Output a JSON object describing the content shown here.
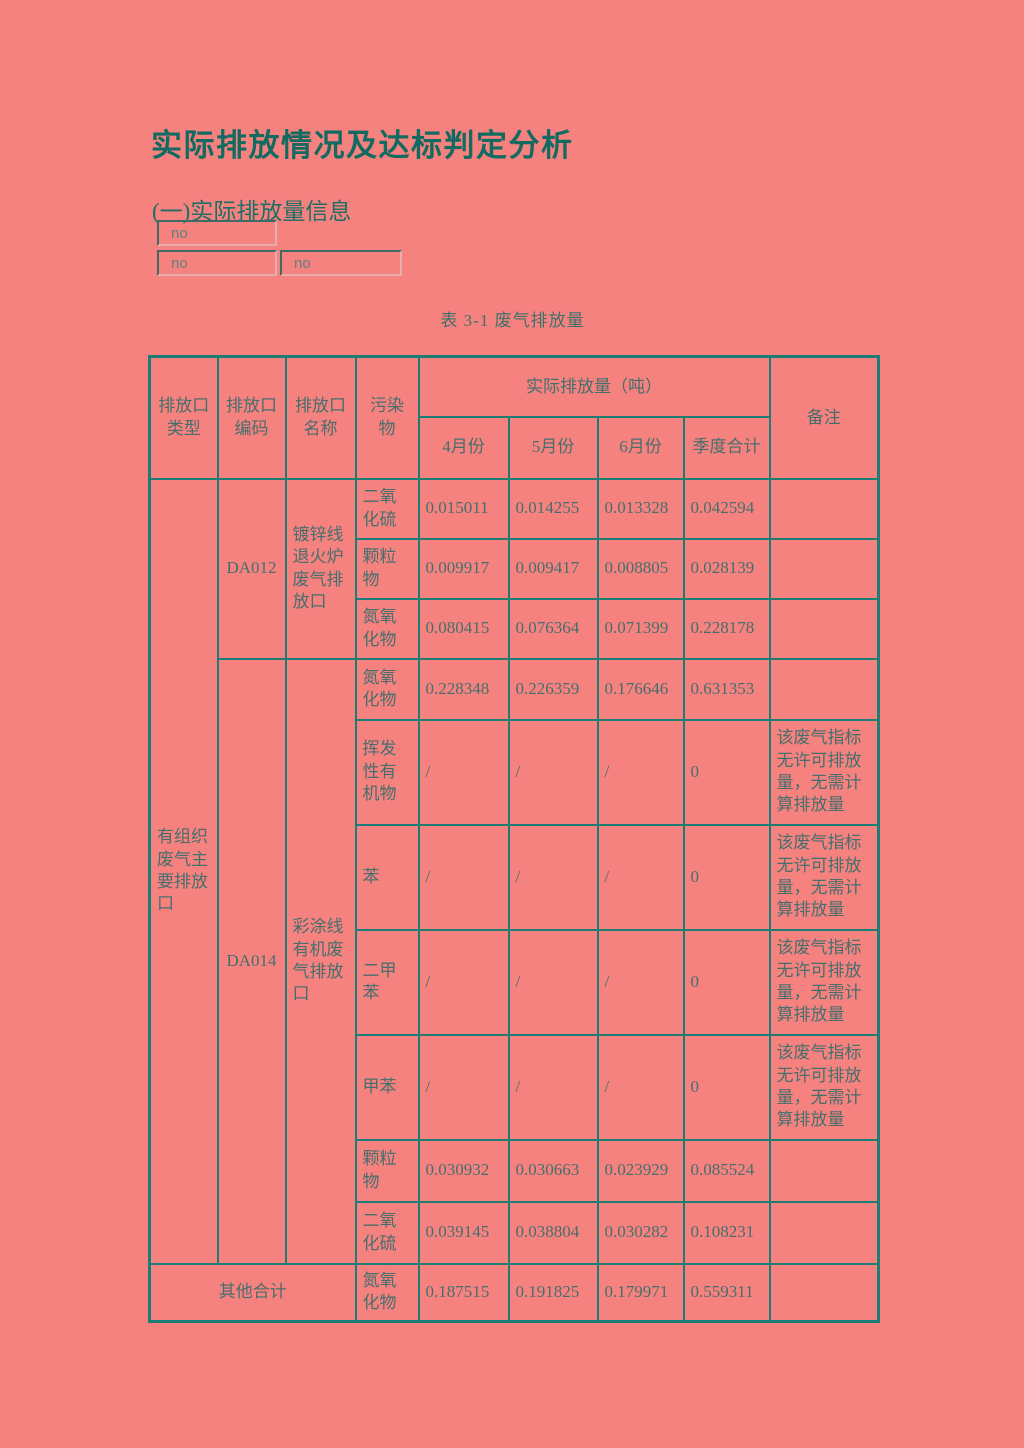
{
  "page": {
    "title": "实际排放情况及达标判定分析",
    "section_heading": "(一)实际排放量信息",
    "table_caption": "表 3-1 废气排放量"
  },
  "fields": [
    {
      "value": "no"
    },
    {
      "value": "no"
    },
    {
      "value": "no"
    }
  ],
  "colors": {
    "page_background": "#f6827f",
    "table_border": "#1b7d75",
    "title_text": "#136a60",
    "table_text": "#456f6d",
    "field_text": "#5d827f"
  },
  "table": {
    "header": {
      "outlet_type": "排放口类型",
      "outlet_code": "排放口编码",
      "outlet_name": "排放口名称",
      "pollutant": "污染物",
      "actual_emissions": "实际排放量（吨）",
      "april": "4月份",
      "may": "5月份",
      "june": "6月份",
      "quarter_total": "季度合计",
      "remark": "备注"
    },
    "group_label": "有组织废气主要排放口",
    "outlets": [
      {
        "code": "DA012",
        "name": "镀锌线退火炉废气排放口"
      },
      {
        "code": "DA014",
        "name": "彩涂线有机废气排放口"
      }
    ],
    "no_permit_remark": "该废气指标无许可排放量，无需计算排放量",
    "rows": [
      {
        "pollutant": "二氧化硫",
        "april": "0.015011",
        "may": "0.014255",
        "june": "0.013328",
        "quarter_total": "0.042594",
        "remark": ""
      },
      {
        "pollutant": "颗粒物",
        "april": "0.009917",
        "may": "0.009417",
        "june": "0.008805",
        "quarter_total": "0.028139",
        "remark": ""
      },
      {
        "pollutant": "氮氧化物",
        "april": "0.080415",
        "may": "0.076364",
        "june": "0.071399",
        "quarter_total": "0.228178",
        "remark": ""
      },
      {
        "pollutant": "氮氧化物",
        "april": "0.228348",
        "may": "0.226359",
        "june": "0.176646",
        "quarter_total": "0.631353",
        "remark": ""
      },
      {
        "pollutant": "挥发性有机物",
        "april": "/",
        "may": "/",
        "june": "/",
        "quarter_total": "0",
        "remark": "该废气指标无许可排放量，无需计算排放量"
      },
      {
        "pollutant": "苯",
        "april": "/",
        "may": "/",
        "june": "/",
        "quarter_total": "0",
        "remark": "该废气指标无许可排放量，无需计算排放量"
      },
      {
        "pollutant": "二甲苯",
        "april": "/",
        "may": "/",
        "june": "/",
        "quarter_total": "0",
        "remark": "该废气指标无许可排放量，无需计算排放量"
      },
      {
        "pollutant": "甲苯",
        "april": "/",
        "may": "/",
        "june": "/",
        "quarter_total": "0",
        "remark": "该废气指标无许可排放量，无需计算排放量"
      },
      {
        "pollutant": "颗粒物",
        "april": "0.030932",
        "may": "0.030663",
        "june": "0.023929",
        "quarter_total": "0.085524",
        "remark": ""
      },
      {
        "pollutant": "二氧化硫",
        "april": "0.039145",
        "may": "0.038804",
        "june": "0.030282",
        "quarter_total": "0.108231",
        "remark": ""
      }
    ],
    "other_total": {
      "label": "其他合计",
      "pollutant": "氮氧化物",
      "april": "0.187515",
      "may": "0.191825",
      "june": "0.179971",
      "quarter_total": "0.559311",
      "remark": ""
    }
  }
}
